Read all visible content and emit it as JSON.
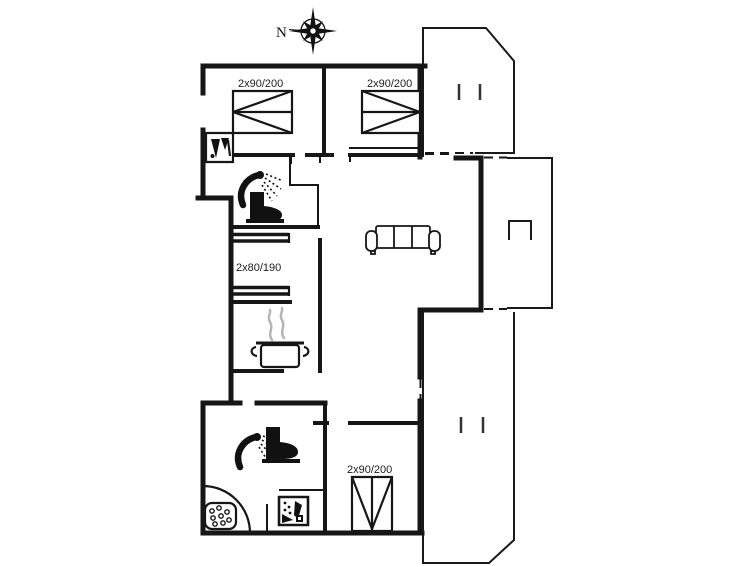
{
  "plan": {
    "compass": {
      "north_label": "N"
    },
    "bed_labels": {
      "bedroom_top_left": "2x90/200",
      "bedroom_top_right": "2x90/200",
      "bunk_room": "2x80/190",
      "bedroom_bottom": "2x90/200"
    },
    "colors": {
      "wall": "#161616",
      "steam_gray": "#b5b5b5",
      "background": "#ffffff"
    },
    "icons": {
      "compass_rose": "8-point compass rose",
      "washing_machine": "washing machine pictogram",
      "shower": "handheld shower head with spray",
      "toilet": "toilet silhouette",
      "sofa": "three-seat sofa outline",
      "cooking_pot": "steaming cooking pot",
      "corner_bath": "corner tub with bubbles",
      "dishwasher": "dishwasher pictogram",
      "grill": "open rectangle terrace marker",
      "double_bed": "bed rectangle with triangle marker",
      "bunk_bed": "double parallel line bunk symbol"
    }
  }
}
